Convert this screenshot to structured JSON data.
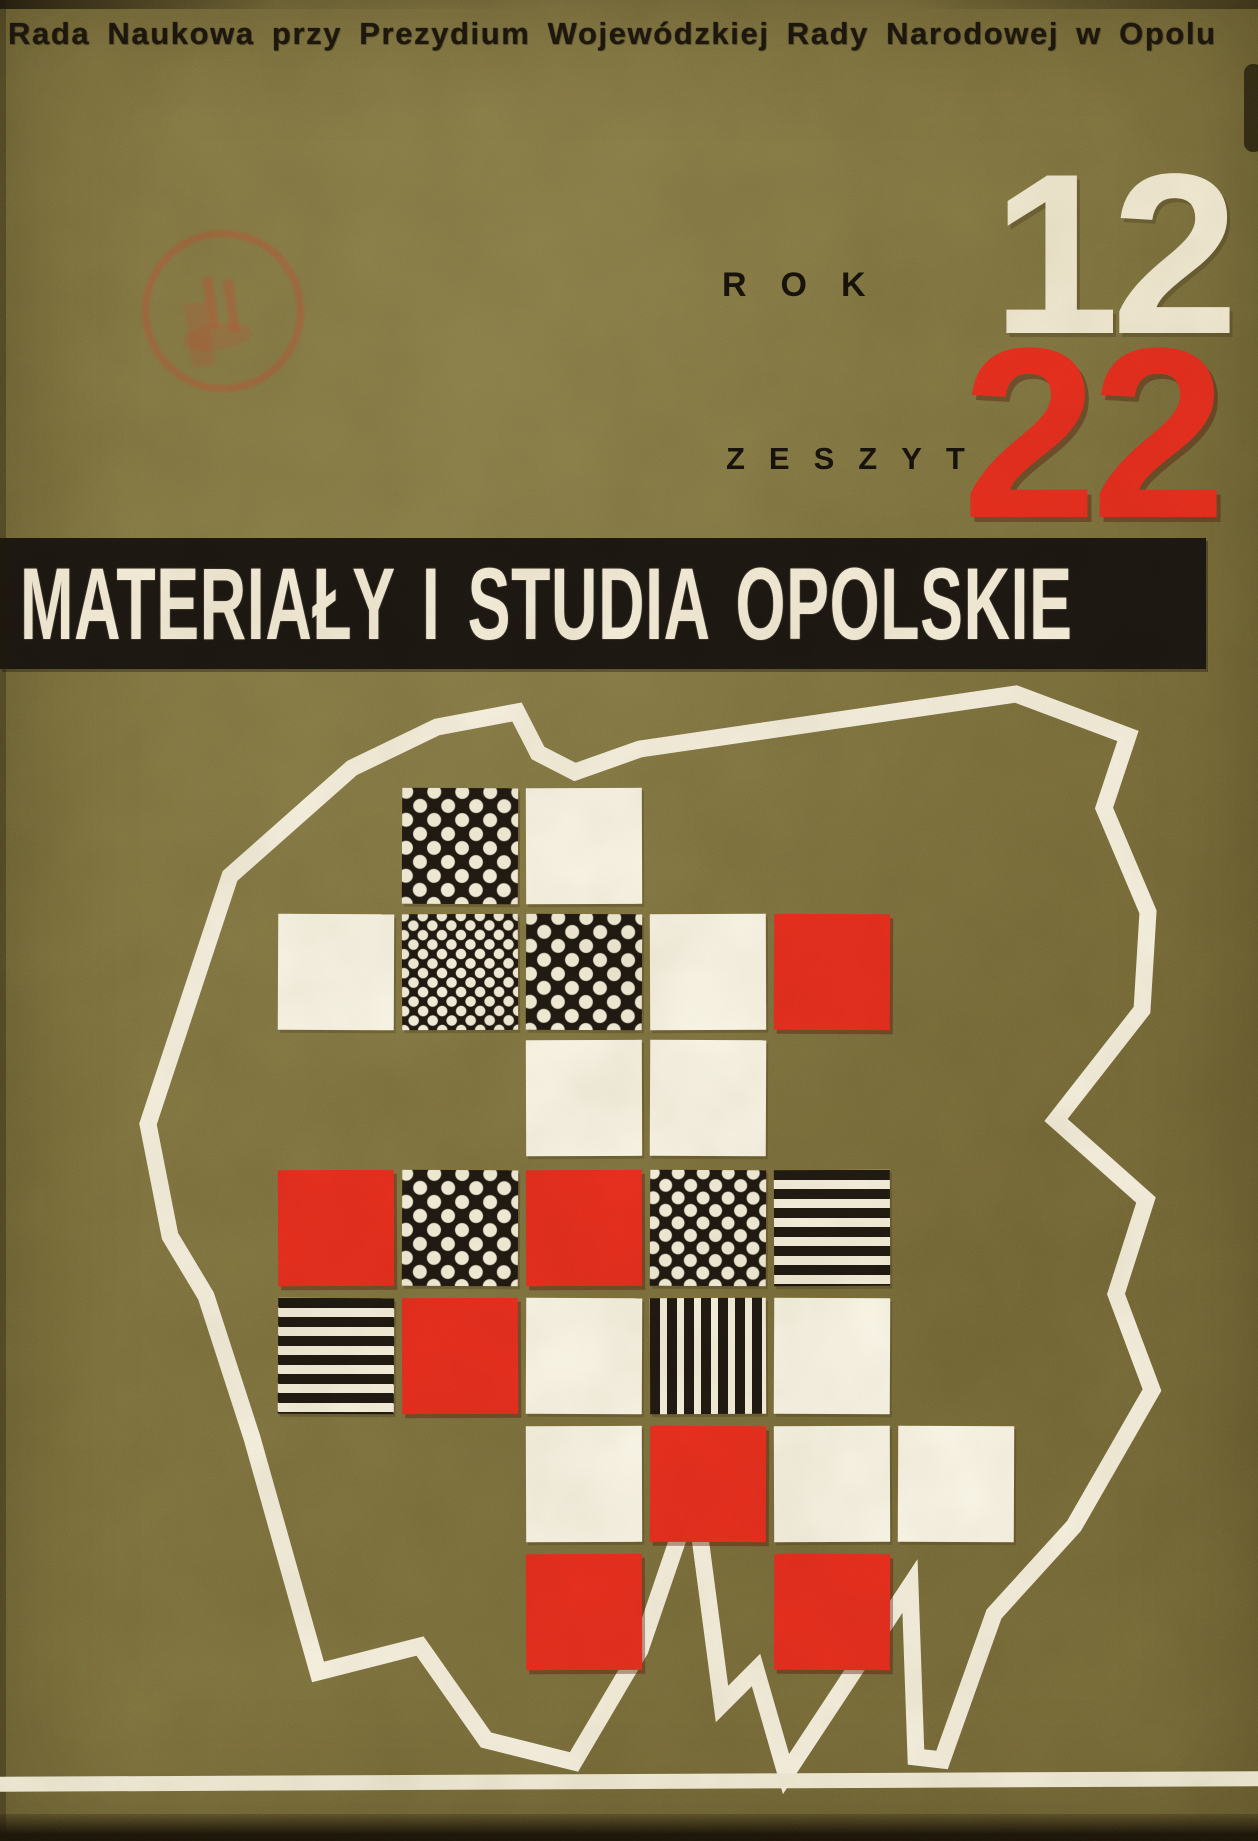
{
  "cover": {
    "publisher_line": "Rada Naukowa przy Prezydium Wojewódzkiej Rady Narodowej w Opolu",
    "rok_label": "ROK",
    "rok_value": "12",
    "zeszyt_label": "ZESZYT",
    "zeszyt_value": "22",
    "title": "MATERIAŁY I STUDIA OPOLSKIE"
  },
  "colors": {
    "background_olive": "#7c713f",
    "banner_black": "#171310",
    "accent_red": "#e6281c",
    "cream": "#f4edda",
    "text_black": "#17120c",
    "stamp_red": "#b94a32"
  },
  "stamp": {
    "type": "circular-ink-stamp",
    "legible": false
  },
  "map": {
    "region": "stylized-voivodeship-outline",
    "outline_points": "148,1124 230,876 352,768 437,727 517,712 538,753 575,772 640,749 845,719 1016,694 1128,736 1104,808 1148,912 1142,1010 1056,1120 1146,1200 1116,1294 1152,1390 1074,1526 994,1614 942,1760 916,1757 910,1586 786,1774 756,1670 722,1704 694,1492 640,1650 574,1762 486,1740 420,1646 318,1672 252,1438 206,1296 170,1236",
    "cell_size": 116,
    "col_x": [
      278,
      402,
      526,
      650,
      774,
      898
    ],
    "row_y": [
      788,
      914,
      1040,
      1170,
      1298,
      1426,
      1554
    ],
    "squares": [
      {
        "row": 0,
        "col": 1,
        "pattern": "dots-lg"
      },
      {
        "row": 0,
        "col": 2,
        "pattern": "white"
      },
      {
        "row": 1,
        "col": 0,
        "pattern": "white"
      },
      {
        "row": 1,
        "col": 1,
        "pattern": "dots-sm"
      },
      {
        "row": 1,
        "col": 2,
        "pattern": "dots-lg"
      },
      {
        "row": 1,
        "col": 3,
        "pattern": "white"
      },
      {
        "row": 1,
        "col": 4,
        "pattern": "red"
      },
      {
        "row": 2,
        "col": 2,
        "pattern": "white"
      },
      {
        "row": 2,
        "col": 3,
        "pattern": "white"
      },
      {
        "row": 3,
        "col": 0,
        "pattern": "red"
      },
      {
        "row": 3,
        "col": 1,
        "pattern": "dots-lg"
      },
      {
        "row": 3,
        "col": 2,
        "pattern": "red"
      },
      {
        "row": 3,
        "col": 3,
        "pattern": "dots-md"
      },
      {
        "row": 3,
        "col": 4,
        "pattern": "stripes-h"
      },
      {
        "row": 4,
        "col": 0,
        "pattern": "stripes-h"
      },
      {
        "row": 4,
        "col": 1,
        "pattern": "red"
      },
      {
        "row": 4,
        "col": 2,
        "pattern": "white"
      },
      {
        "row": 4,
        "col": 3,
        "pattern": "stripes-v"
      },
      {
        "row": 4,
        "col": 4,
        "pattern": "white"
      },
      {
        "row": 5,
        "col": 2,
        "pattern": "white"
      },
      {
        "row": 5,
        "col": 3,
        "pattern": "red"
      },
      {
        "row": 5,
        "col": 4,
        "pattern": "white"
      },
      {
        "row": 5,
        "col": 5,
        "pattern": "white"
      },
      {
        "row": 6,
        "col": 2,
        "pattern": "red"
      },
      {
        "row": 6,
        "col": 4,
        "pattern": "red"
      }
    ]
  }
}
